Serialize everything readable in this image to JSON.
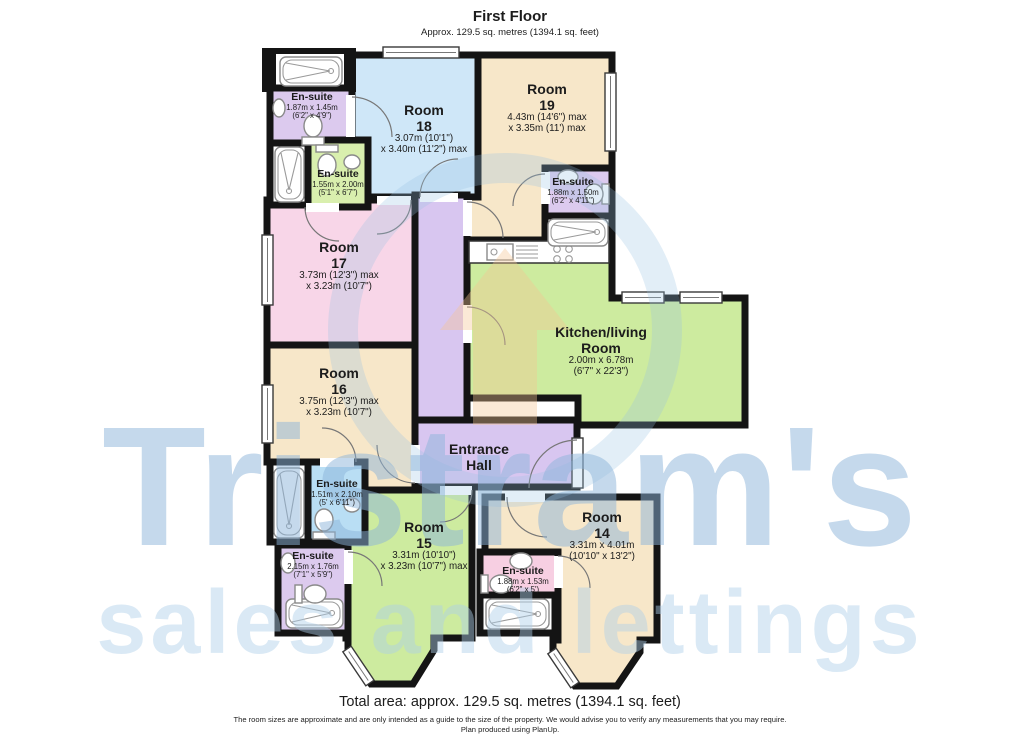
{
  "header": {
    "title": "First Floor",
    "subtitle": "Approx. 129.5 sq. metres (1394.1 sq. feet)"
  },
  "footer": {
    "total": "Total area: approx. 129.5 sq. metres (1394.1 sq. feet)",
    "disclaimer": "The room sizes are approximate and are only intended as a guide to the size of the property. We would advise you to verify any measurements that you may require.",
    "produced": "Plan produced using PlanUp."
  },
  "watermark": {
    "line1": "Tristram's",
    "line2": "sales and lettings"
  },
  "colors": {
    "room_tan": "#f7e7c9",
    "room_blue": "#cfe7f8",
    "room_pink": "#f8d6e8",
    "room_green": "#cdeb9f",
    "hall_purple": "#d8c6f0",
    "ensuite_purple": "#dccaee",
    "ensuite_green": "#d9efae",
    "ensuite_blue": "#b9def4",
    "ensuite_pink": "#f7cfe2",
    "wall": "#141414",
    "watermark_blue": "#a9cce9"
  },
  "rooms": {
    "room18": {
      "name_lines": [
        "Room",
        "18"
      ],
      "dim_lines": [
        "3.07m (10'1\")",
        "x 3.40m (11'2\") max"
      ]
    },
    "room19": {
      "name_lines": [
        "Room",
        "19"
      ],
      "dim_lines": [
        "4.43m (14'6\") max",
        "x 3.35m (11') max"
      ]
    },
    "room17": {
      "name_lines": [
        "Room",
        "17"
      ],
      "dim_lines": [
        "3.73m (12'3\") max",
        "x 3.23m (10'7\")"
      ]
    },
    "room16": {
      "name_lines": [
        "Room",
        "16"
      ],
      "dim_lines": [
        "3.75m (12'3\") max",
        "x 3.23m (10'7\")"
      ]
    },
    "room15": {
      "name_lines": [
        "Room",
        "15"
      ],
      "dim_lines": [
        "3.31m (10'10\")",
        "x 3.23m (10'7\") max"
      ]
    },
    "room14": {
      "name_lines": [
        "Room",
        "14"
      ],
      "dim_lines": [
        "3.31m x 4.01m",
        "(10'10\" x 13'2\")"
      ]
    },
    "kitchen": {
      "name_lines": [
        "Kitchen/living",
        "Room"
      ],
      "dim_lines": [
        "2.00m x 6.78m",
        "(6'7\" x 22'3\")"
      ]
    },
    "hall": {
      "name_lines": [
        "Entrance",
        "Hall"
      ]
    },
    "ensuite_tl": {
      "name": "En-suite",
      "dim_lines": [
        "1.87m x 1.45m",
        "(6'2\" x 4'9\")"
      ]
    },
    "ensuite_green": {
      "name": "En-suite",
      "dim_lines": [
        "1.55m x 2.00m",
        "(5'1\" x 6'7\")"
      ]
    },
    "ensuite_right": {
      "name": "En-suite",
      "dim_lines": [
        "1.88m x 1.50m",
        "(6'2\" x 4'11\")"
      ]
    },
    "ensuite_blue": {
      "name": "En-suite",
      "dim_lines": [
        "1.51m x 2.10m",
        "(5' x 6'11\")"
      ]
    },
    "ensuite_left": {
      "name": "En-suite",
      "dim_lines": [
        "2.15m x 1.76m",
        "(7'1\" x 5'9\")"
      ]
    },
    "ensuite_pink": {
      "name": "En-suite",
      "dim_lines": [
        "1.88m x 1.53m",
        "(6'2\" x 5')"
      ]
    }
  }
}
